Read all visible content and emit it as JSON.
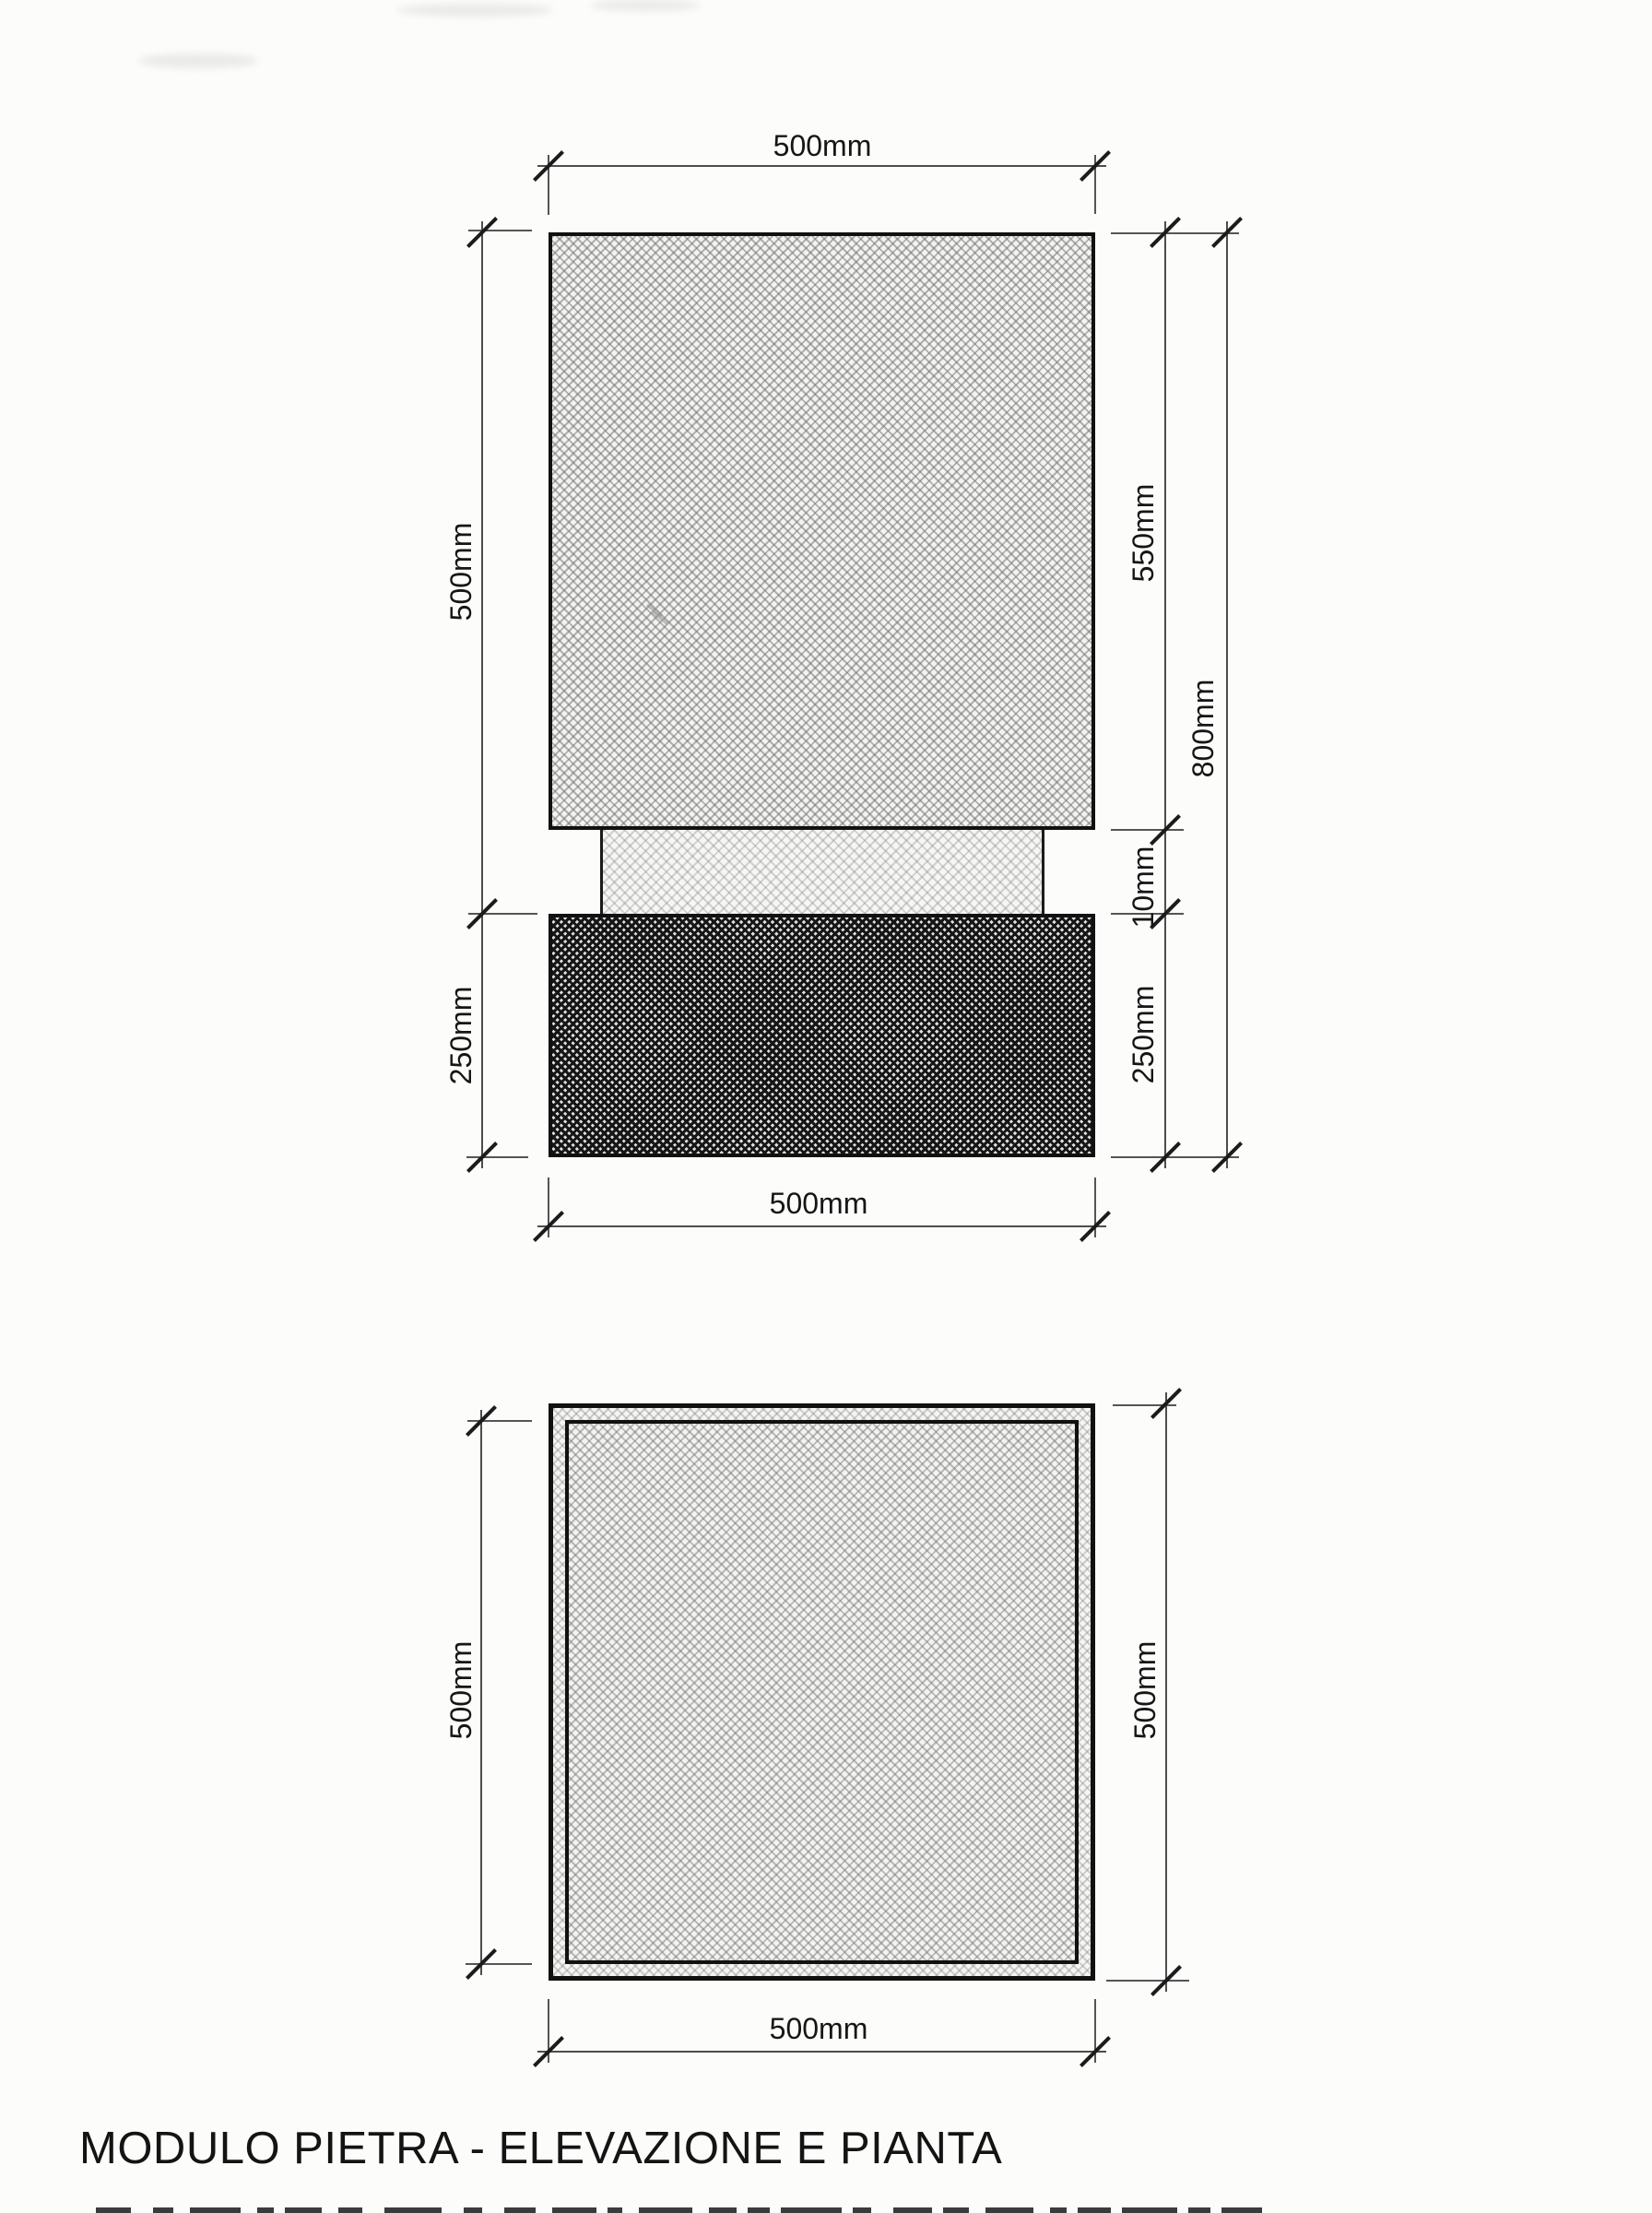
{
  "title": "MODULO PIETRA - ELEVAZIONE E PIANTA",
  "elevation": {
    "top_width": "500mm",
    "left_height_upper": "500mm",
    "left_height_base": "250mm",
    "right_height_upper": "550mm",
    "right_joint": "10mm",
    "right_height_base": "250mm",
    "right_total_height": "800mm",
    "bottom_width": "500mm"
  },
  "plan": {
    "left_height": "500mm",
    "right_height": "500mm",
    "bottom_width": "500mm"
  },
  "colors": {
    "background": "#fcfcfb",
    "dimension_line": "#4d4d4d",
    "block_border": "#111111",
    "label_text": "#161616"
  }
}
